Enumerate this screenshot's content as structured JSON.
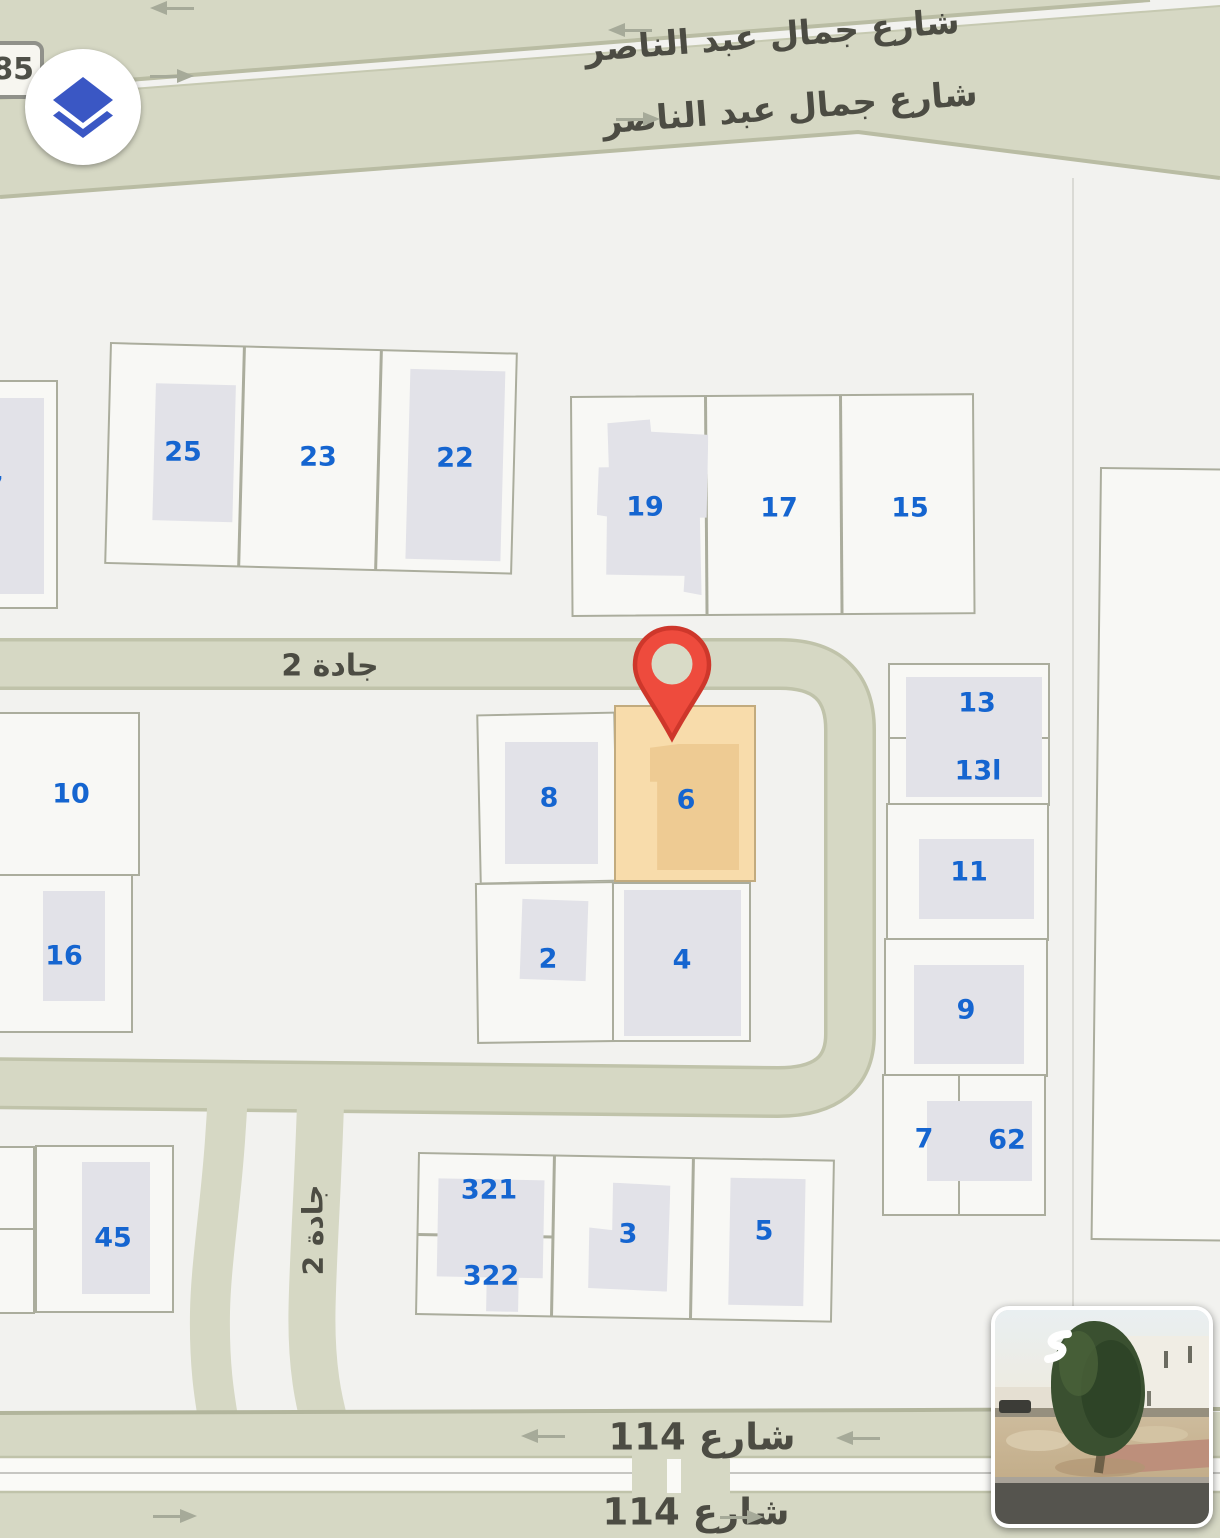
{
  "map": {
    "controls": {
      "layers_button": {
        "icon": "layers-icon"
      },
      "route_badge": "85"
    },
    "streets": {
      "nasser_top": "شارع جمال عبد الناصر",
      "nasser_bottom": "شارع جمال عبد الناصر",
      "jaddah2_horizontal": "جادة 2",
      "jaddah2_vertical": "جادة 2",
      "street114_top": "شارع 114",
      "street114_bottom": "شارع 114"
    },
    "parcels": [
      {
        "label": "7"
      },
      {
        "label": "25"
      },
      {
        "label": "23"
      },
      {
        "label": "22"
      },
      {
        "label": "19"
      },
      {
        "label": "17"
      },
      {
        "label": "15"
      },
      {
        "label": "10"
      },
      {
        "label": "16"
      },
      {
        "label": "8"
      },
      {
        "label": "6"
      },
      {
        "label": "2"
      },
      {
        "label": "4"
      },
      {
        "label": "13"
      },
      {
        "label": "13ا"
      },
      {
        "label": "11"
      },
      {
        "label": "9"
      },
      {
        "label": "7"
      },
      {
        "label": "62"
      },
      {
        "label": "45"
      },
      {
        "label": "321"
      },
      {
        "label": "322"
      },
      {
        "label": "3"
      },
      {
        "label": "5"
      }
    ],
    "marker": {
      "type": "location-pin",
      "on_parcel": "6",
      "color": "#ee4b3d"
    },
    "street_view_thumbnail": {
      "present": true
    },
    "colors": {
      "road": "#d6d8c4",
      "road_border": "#b9bca3",
      "parcel_border": "#abad9d",
      "parcel_fill": "#f8f8f5",
      "building": "#e2e2e8",
      "highlight_parcel": "#f8dcab",
      "number_blue": "#1565d0",
      "street_text": "#4c4c43",
      "pin_red": "#ee4b3d"
    }
  }
}
